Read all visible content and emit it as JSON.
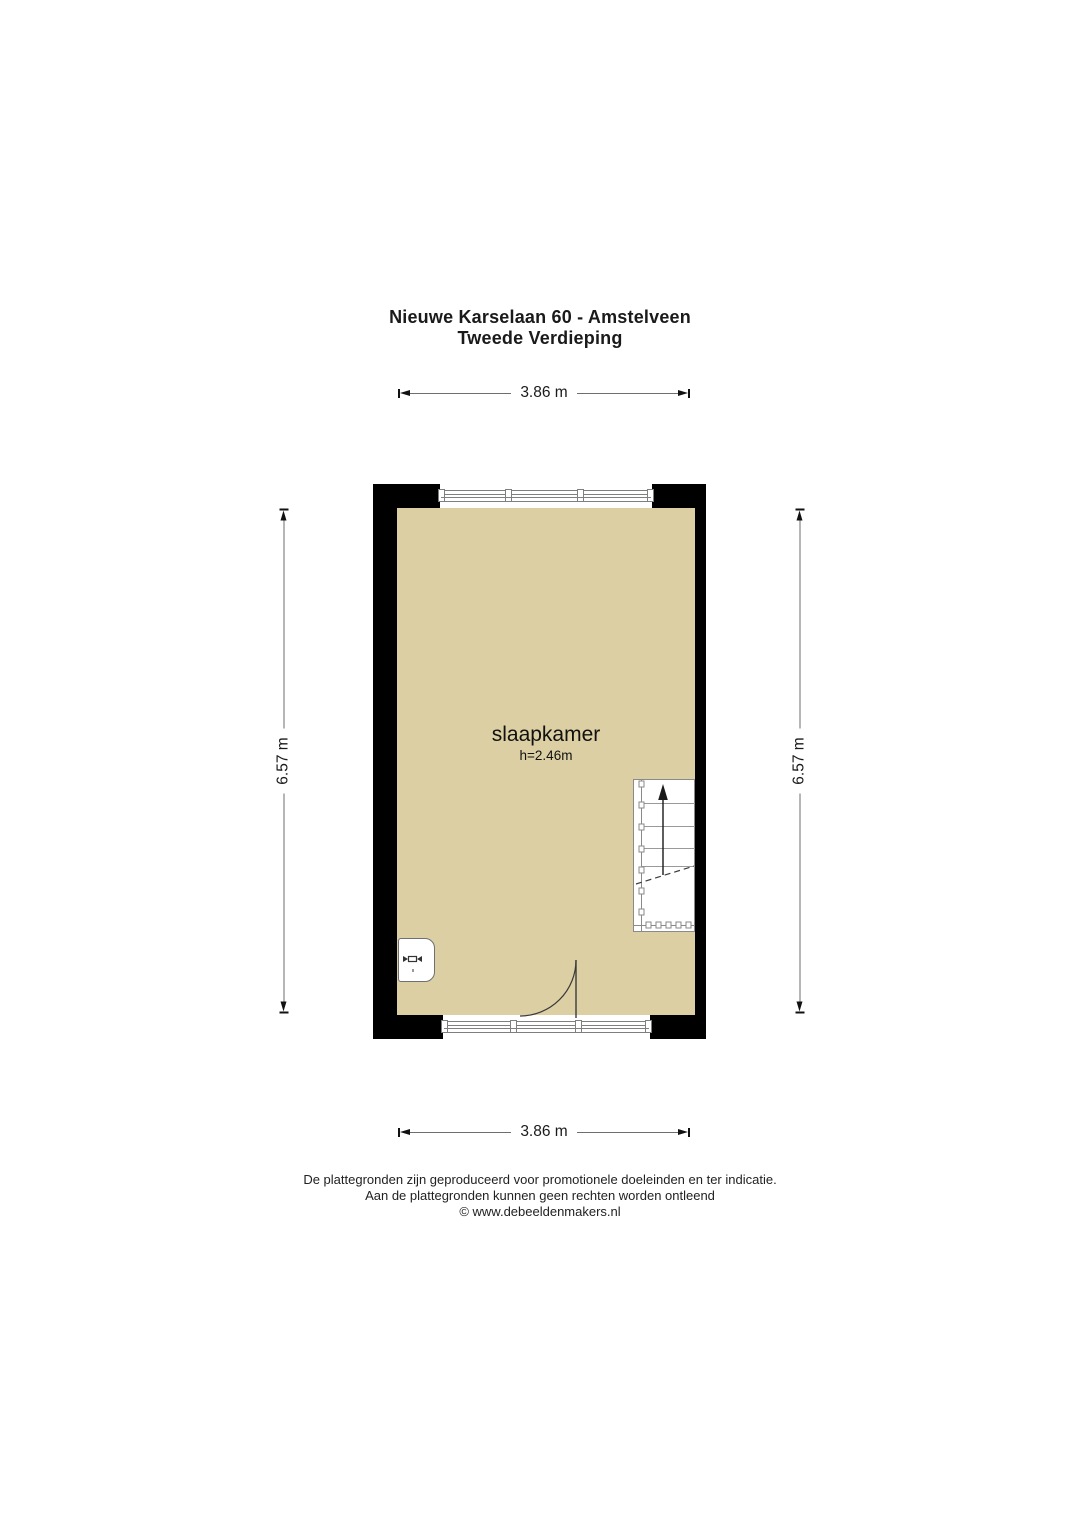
{
  "title": {
    "line1": "Nieuwe Karselaan 60 - Amstelveen",
    "line2": "Tweede Verdieping"
  },
  "dimensions": {
    "width_top": "3.86 m",
    "width_bottom": "3.86 m",
    "height_left": "6.57 m",
    "height_right": "6.57 m"
  },
  "room": {
    "name": "slaapkamer",
    "ceiling_height": "h=2.46m"
  },
  "footer": {
    "line1": "De plattegronden zijn geproduceerd voor promotionele doeleinden en ter indicatie.",
    "line2": "Aan de plattegronden kunnen geen rechten worden ontleend",
    "line3": "© www.debeeldenmakers.nl"
  },
  "colors": {
    "floor": "#DCCFA3",
    "wall": "#000000",
    "window_line": "#7F7F7F",
    "stair_line": "#8A8A8A",
    "dimension_line": "#6E6E6E",
    "text": "#1A1A1A"
  }
}
